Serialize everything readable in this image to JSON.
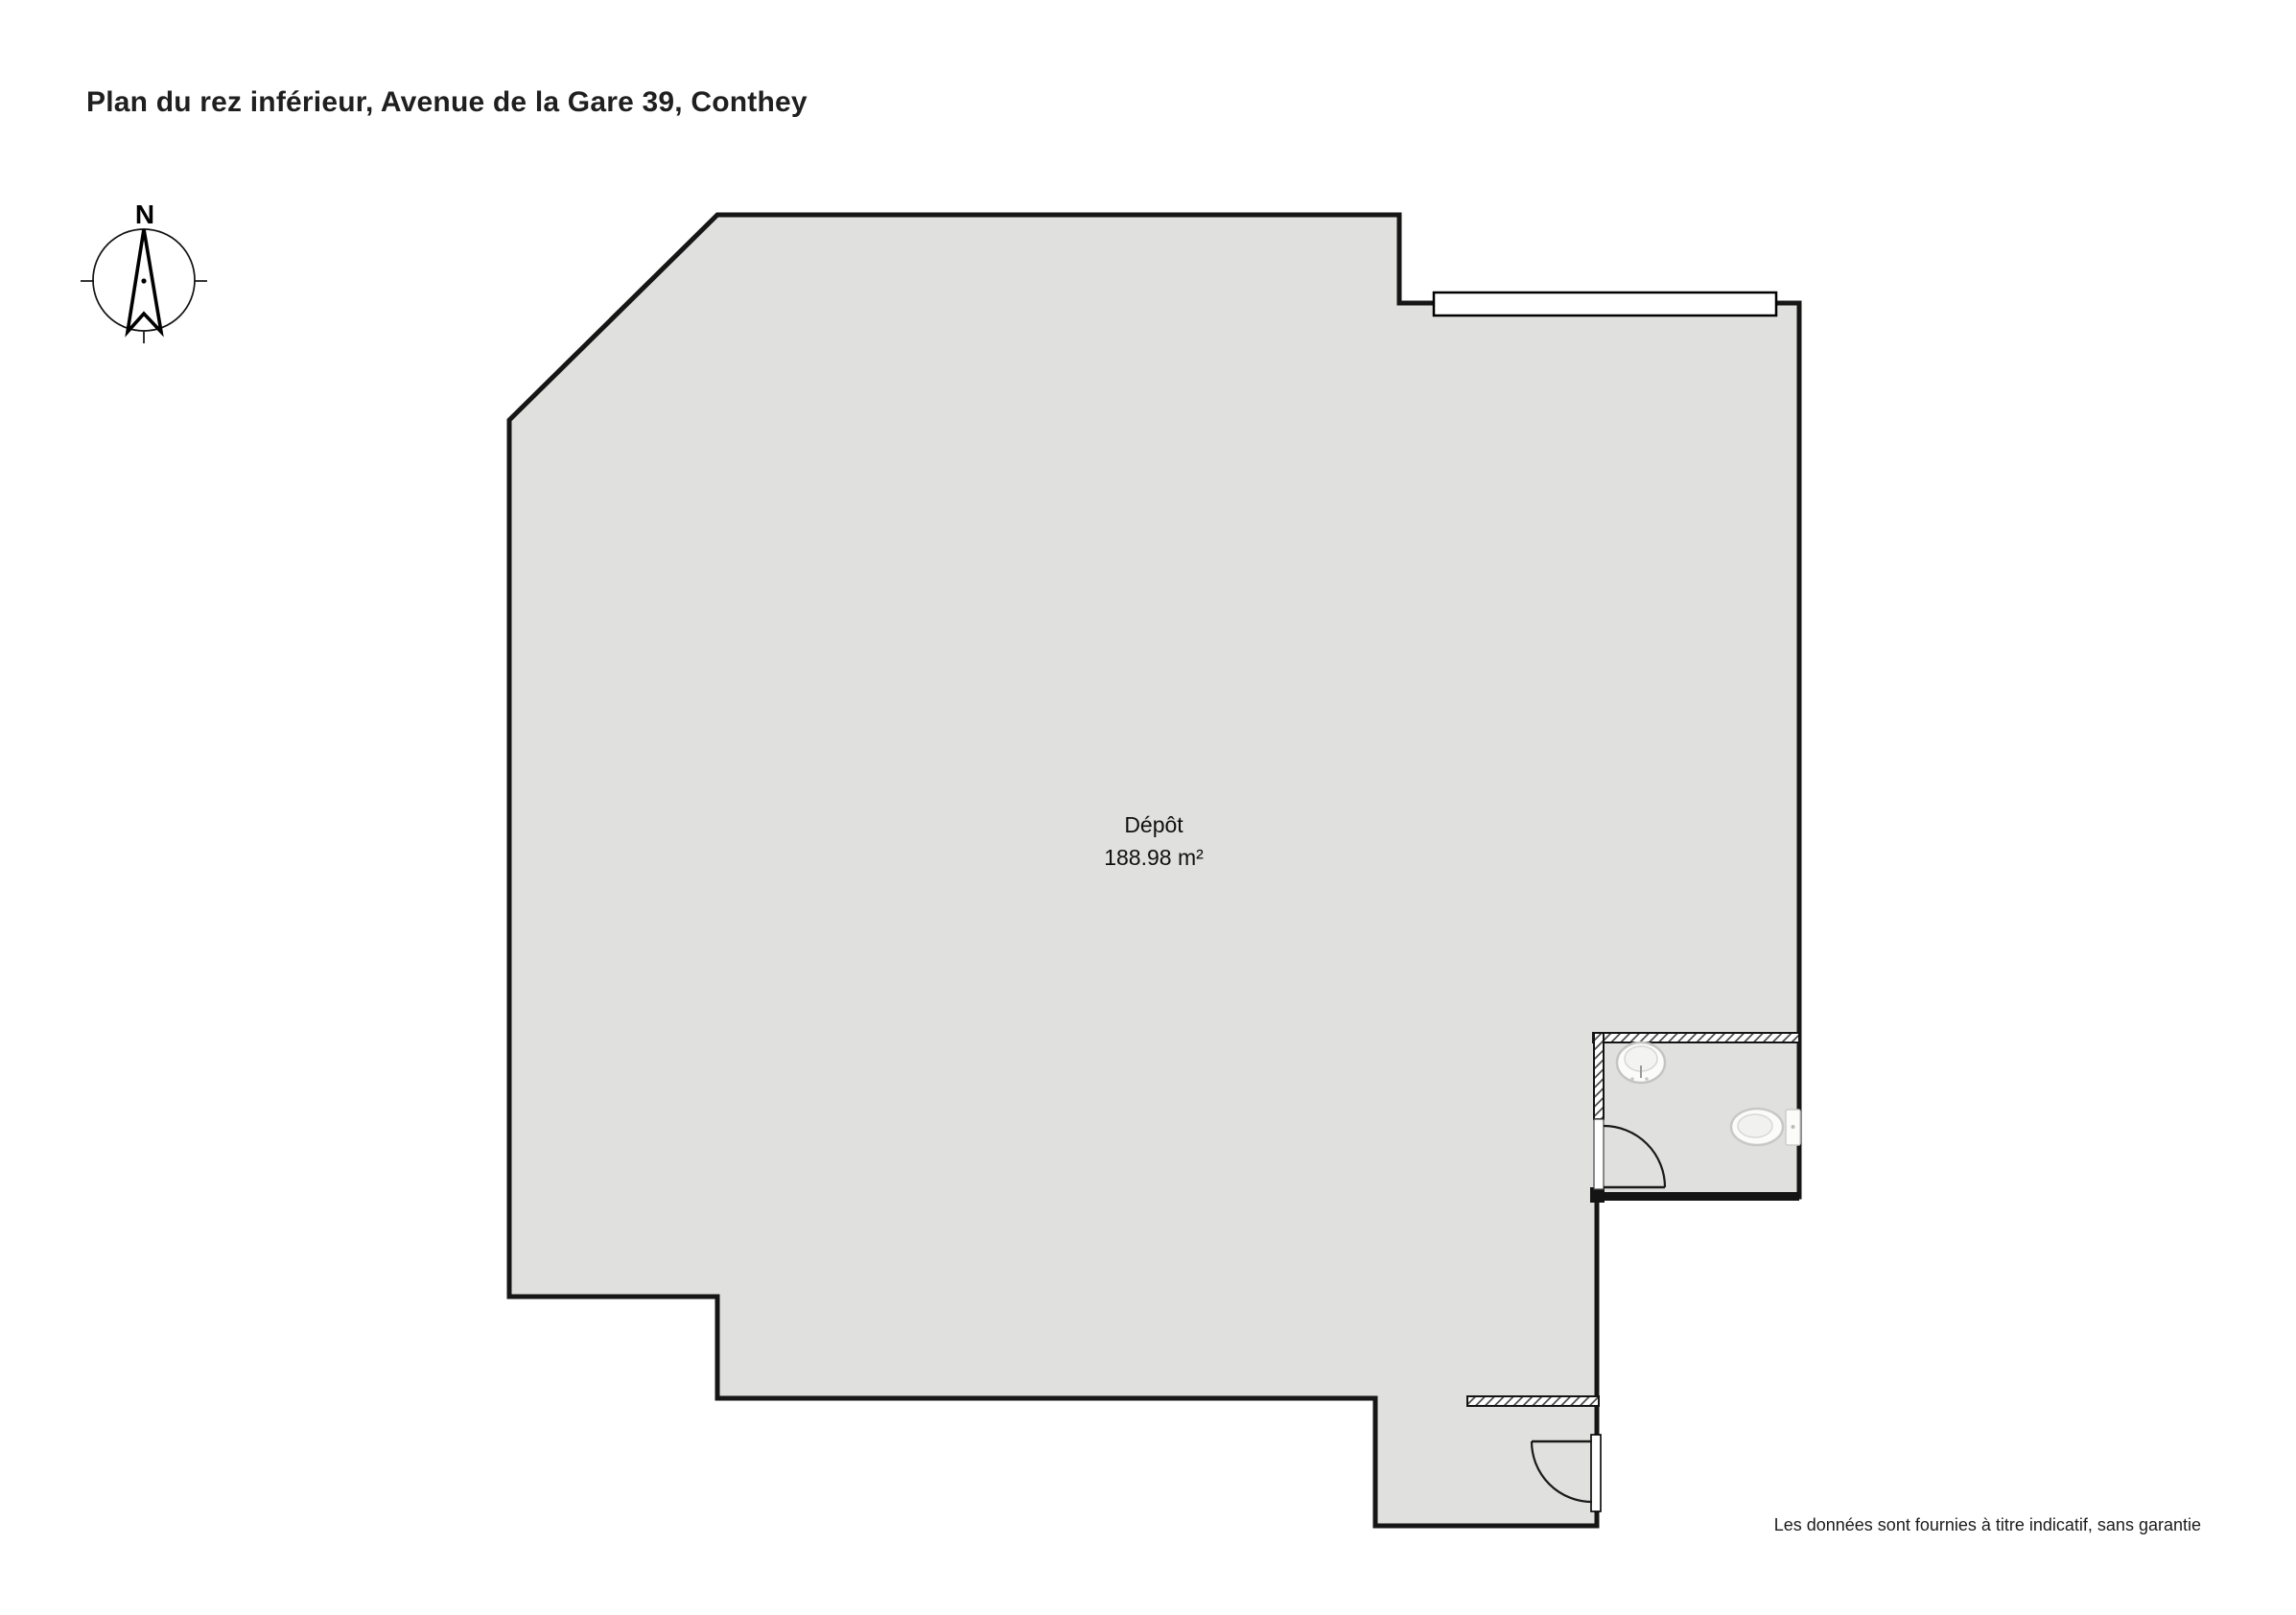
{
  "page": {
    "title": "Plan du rez inférieur, Avenue de la Gare 39, Conthey"
  },
  "compass": {
    "north_label": "N",
    "icon": "compass-north-arrow"
  },
  "room": {
    "name": "Dépôt",
    "area": "188.98 m²"
  },
  "fixtures": {
    "sink_icon": "sink-top-view",
    "toilet_icon": "toilet-top-view",
    "window_icon": "window-in-wall",
    "door_icon": "door-swing-arc"
  },
  "footer": {
    "disclaimer": "Les données sont fournies à titre indicatif, sans garantie"
  },
  "colors": {
    "floor": "#e0e0de",
    "wall": "#161616",
    "window-fill": "#ffffff",
    "fixture-fill": "#fbfbfa",
    "fixture-border": "#c8c8c6",
    "hatch-line": "#3a3a3a"
  }
}
